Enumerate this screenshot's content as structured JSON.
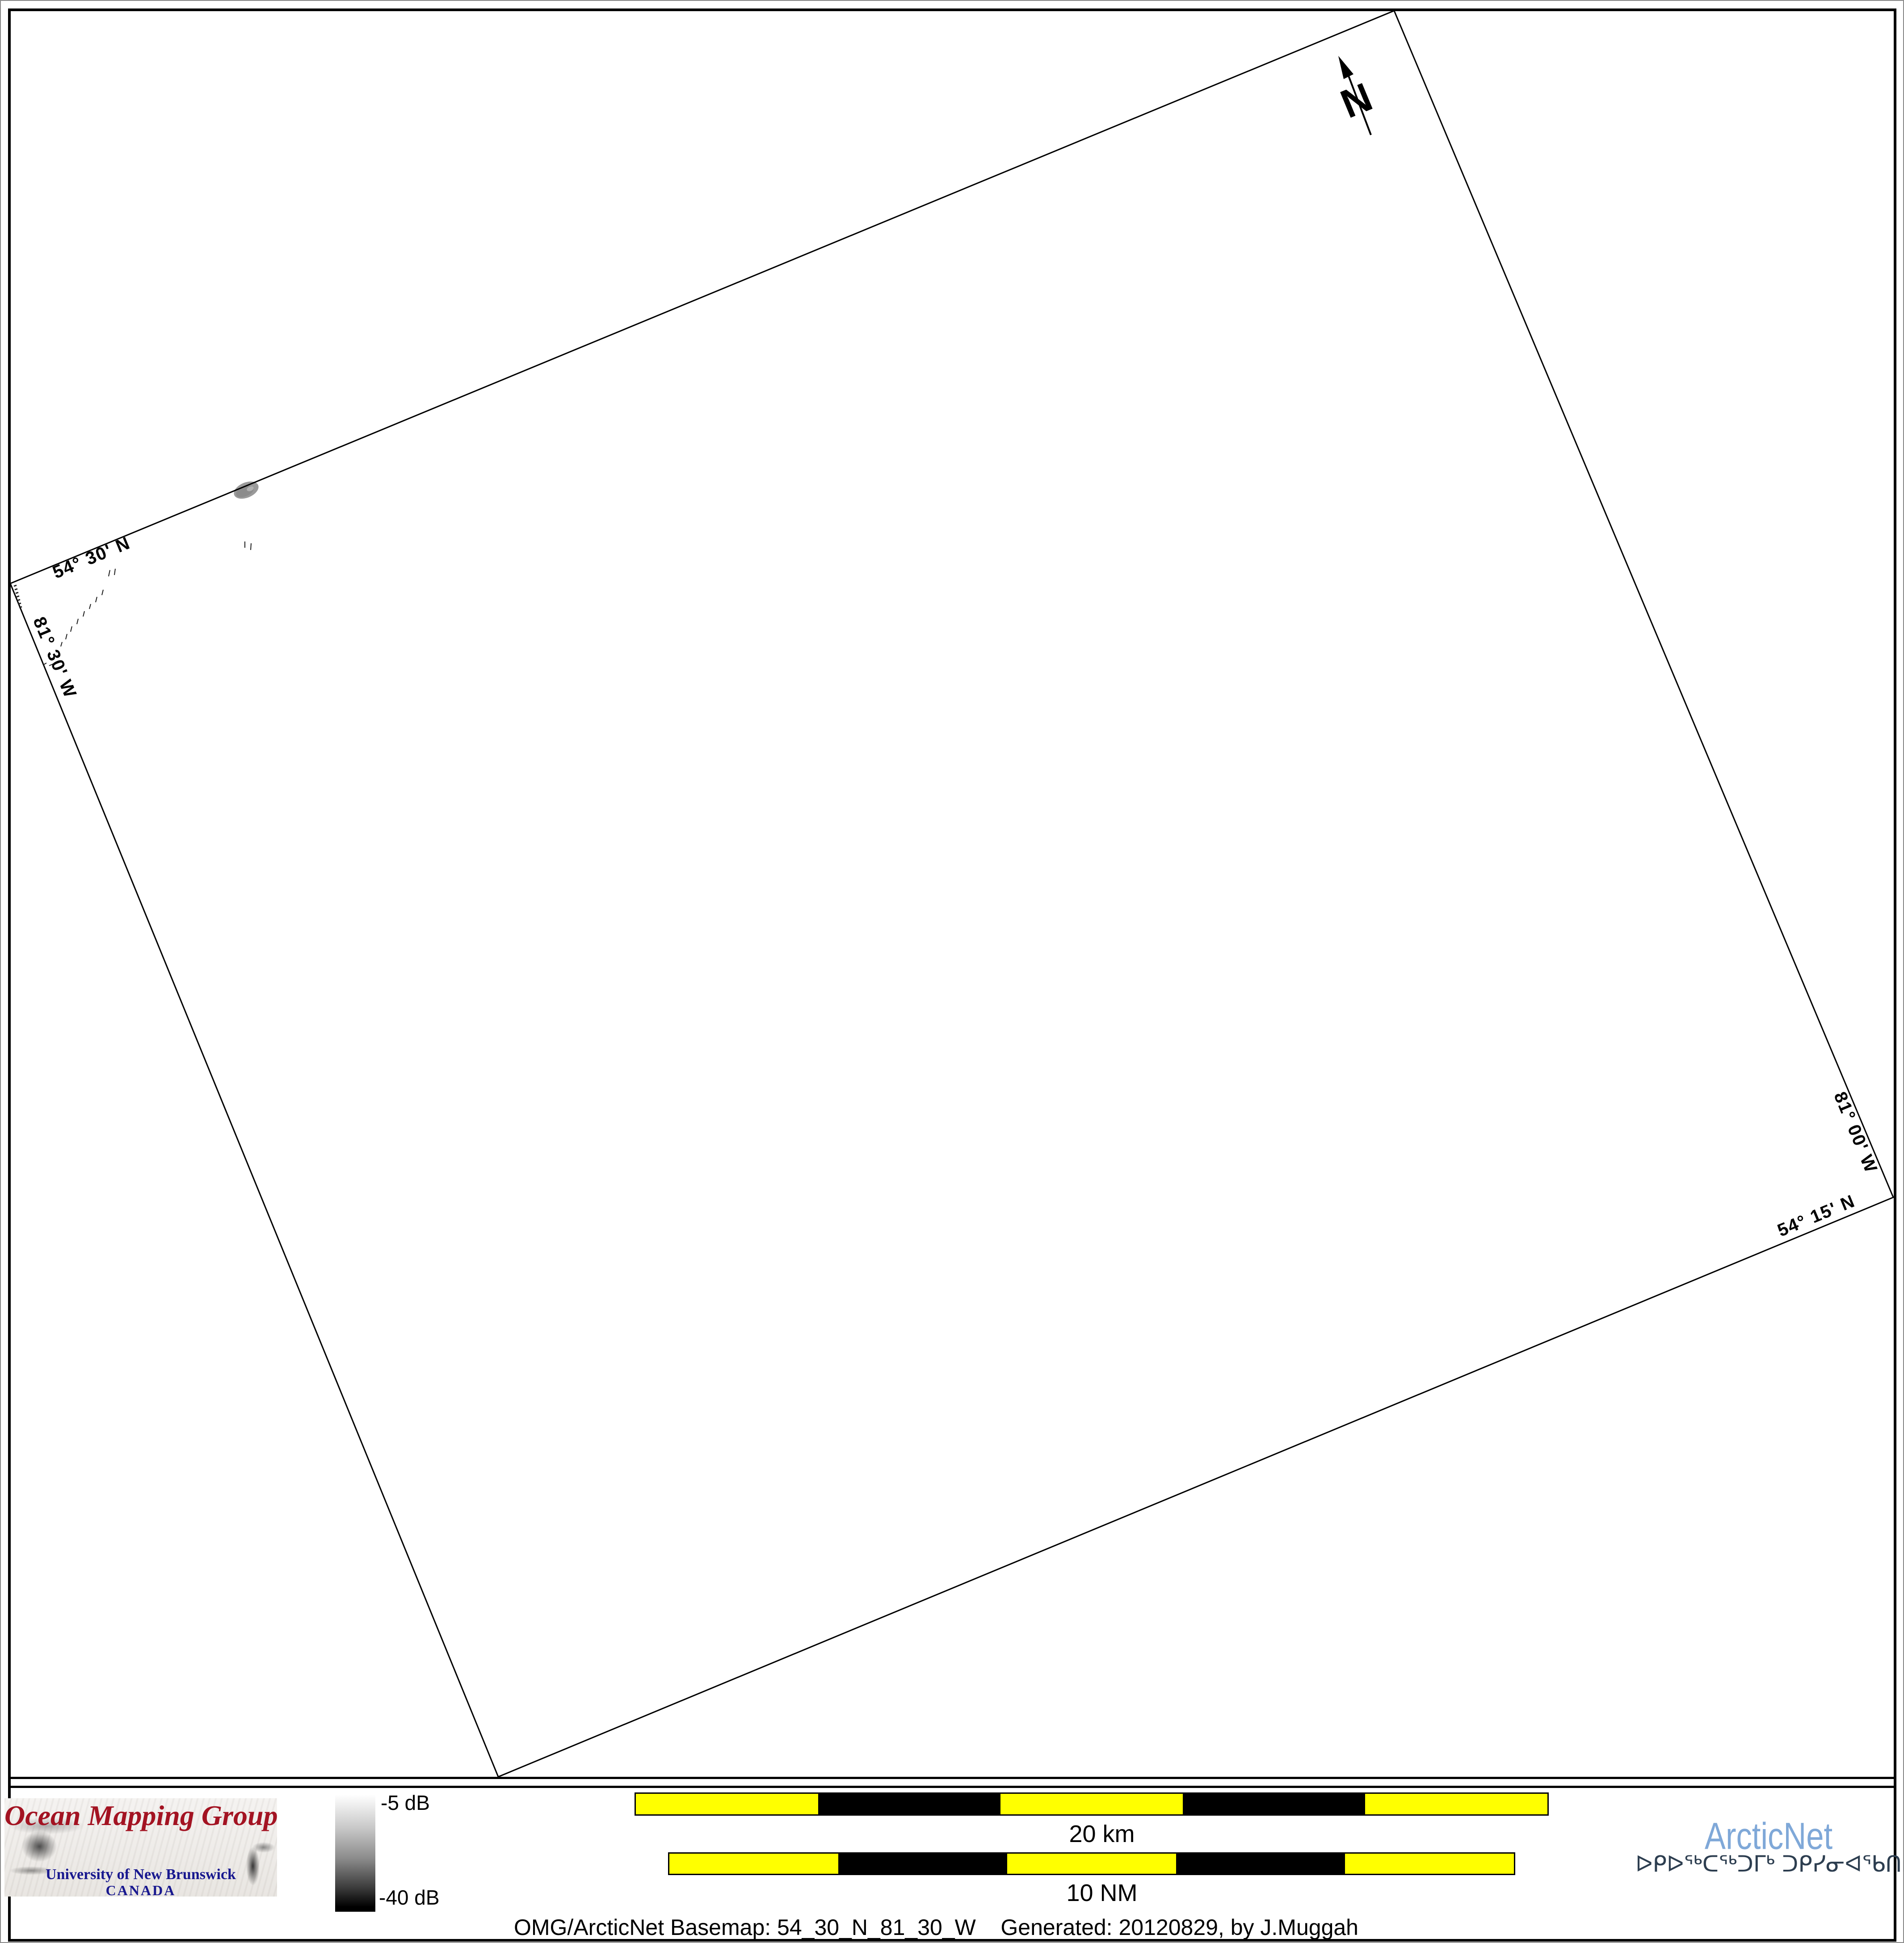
{
  "map": {
    "corner_labels": {
      "lat_top": "54° 30' N",
      "lon_left": "81° 30' W",
      "lon_right": "81° 00' W",
      "lat_bottom": "54° 15' N"
    },
    "north_arrow_label": "N"
  },
  "legend": {
    "colorbar_top_label": "-5 dB",
    "colorbar_bottom_label": "-40 dB"
  },
  "scalebars": {
    "km_label": "20 km",
    "nm_label": "10 NM"
  },
  "footer": {
    "caption": "OMG/ArcticNet Basemap: 54_30_N_81_30_W    Generated: 20120829, by J.Muggah"
  },
  "logos": {
    "omg": {
      "title": "Ocean Mapping Group",
      "institution": "University of New Brunswick",
      "country": "CANADA"
    },
    "arcticnet": {
      "name": "ArcticNet",
      "inuktitut": "ᐅᑭᐅᖅᑕᖅᑐᒥᒃ ᑐᑭᓯᓂᐊᖃᑎᒌᑦ"
    }
  },
  "colors": {
    "omg_red": "#a31322",
    "unb_blue": "#18188f",
    "arcticnet_blue": "#7fa8d8",
    "inuktitut_navy": "#2d3e50",
    "scalebar_yellow": "#ffff00",
    "frame_black": "#000000",
    "sonar_patch_gray": "#9a9a9a"
  }
}
